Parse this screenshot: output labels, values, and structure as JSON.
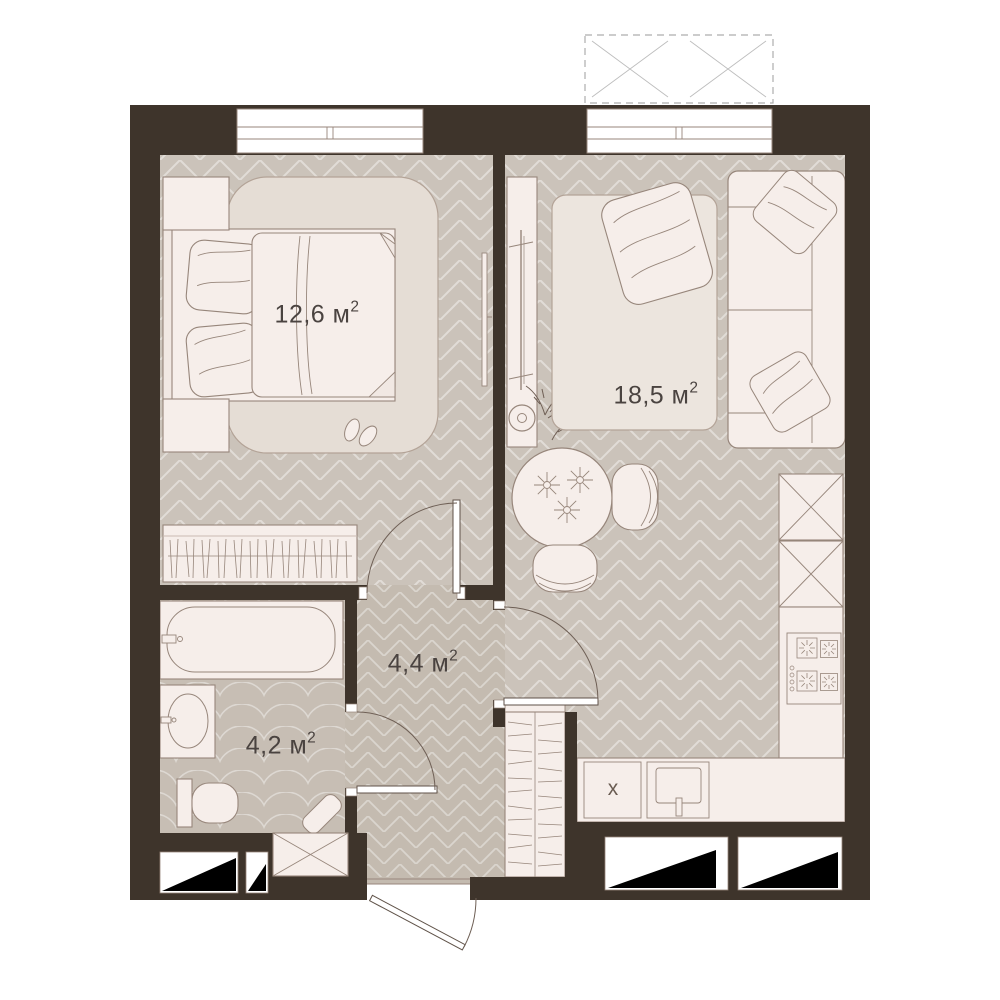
{
  "plan_type": "apartment-floor-plan",
  "rooms": {
    "bedroom": {
      "label": "12,6 м",
      "sup": "2"
    },
    "living_room": {
      "label": "18,5 м",
      "sup": "2"
    },
    "hallway": {
      "label": "4,4 м",
      "sup": "2"
    },
    "bathroom": {
      "label": "4,2 м",
      "sup": "2"
    }
  },
  "markers": {
    "kitchen_appliance": "х"
  },
  "colors": {
    "wall": "#3E342B",
    "floor_main": "#CBC3BA",
    "floor_hall": "#C4BBB0",
    "floor_bath": "#C7BEB4",
    "furniture": "#F6EEEA",
    "outline": "#97867B",
    "vent": "#000000"
  }
}
